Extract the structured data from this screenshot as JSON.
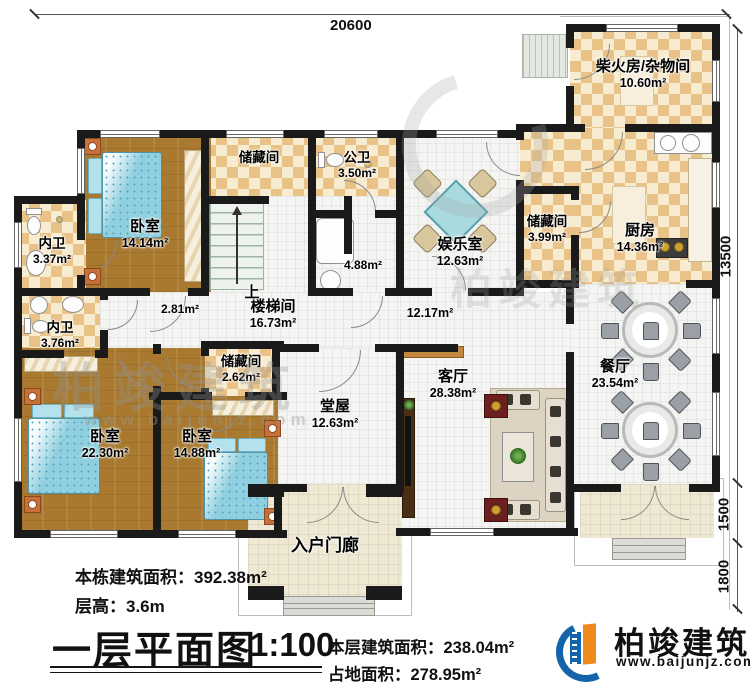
{
  "dimensions": {
    "top": "20600",
    "right_main": "13500",
    "right_mid": "1500",
    "right_bottom": "1800"
  },
  "stairs": {
    "up_label": "上"
  },
  "rooms": {
    "chaihuofang": {
      "name": "柴火房/杂物间",
      "area": "10.60m²"
    },
    "kitchen": {
      "name": "厨房",
      "area": "14.36m²"
    },
    "storage_399": {
      "name": "储藏间",
      "area": "3.99m²"
    },
    "dining": {
      "name": "餐厅",
      "area": "23.54m²"
    },
    "entertainment": {
      "name": "娱乐室",
      "area": "12.63m²"
    },
    "public_bath": {
      "name": "公卫",
      "area": "3.50m²"
    },
    "bath_488": {
      "name": "",
      "area": "4.88m²"
    },
    "storage_top": {
      "name": "储藏间",
      "area": ""
    },
    "bedroom_tl": {
      "name": "卧室",
      "area": "14.14m²"
    },
    "neiwei_1": {
      "name": "内卫",
      "area": "3.37m²"
    },
    "neiwei_2": {
      "name": "内卫",
      "area": "3.76m²"
    },
    "hall_small": {
      "name": "",
      "area": "2.81m²"
    },
    "stair_hall": {
      "name": "楼梯间",
      "area": "16.73m²"
    },
    "hall_main": {
      "name": "",
      "area": "12.17m²"
    },
    "storage_262": {
      "name": "储藏间",
      "area": "2.62m²"
    },
    "bedroom_bl": {
      "name": "卧室",
      "area": "22.30m²"
    },
    "bedroom_bm": {
      "name": "卧室",
      "area": "14.88m²"
    },
    "tangwu": {
      "name": "堂屋",
      "area": "12.63m²"
    },
    "living": {
      "name": "客厅",
      "area": "28.38m²"
    },
    "porch": {
      "name": "入户门廊",
      "area": ""
    }
  },
  "title_block": {
    "building_area_label": "本栋建筑面积：",
    "building_area_value": "392.38m²",
    "floor_height_label": "层高：",
    "floor_height_value": "3.6m",
    "plan_title": "一层平面图",
    "scale": "1:100",
    "floor_area_label": "本层建筑面积：",
    "floor_area_value": "238.04m²",
    "footprint_label": "占地面积：",
    "footprint_value": "278.95m²"
  },
  "logo": {
    "name": "柏竣建筑",
    "website": "www.baijunjz.com"
  },
  "watermark": {
    "text": "柏竣建筑",
    "url": "www.baijunjz.com"
  }
}
